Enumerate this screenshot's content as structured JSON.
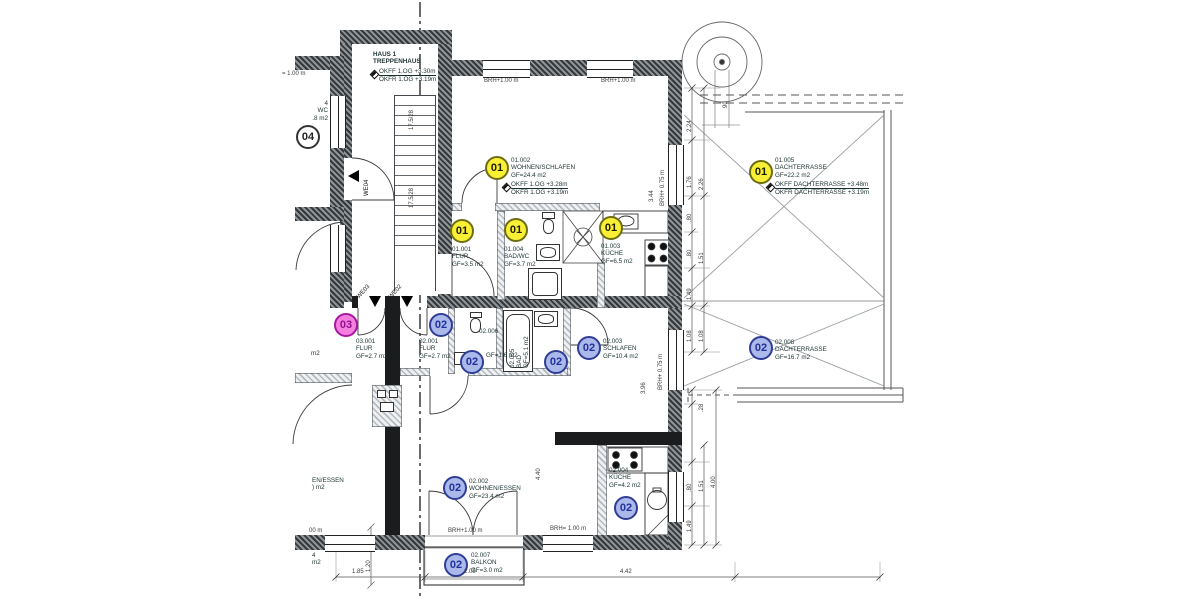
{
  "badges": {
    "u01": {
      "text": "01",
      "fill": "#f9ef35",
      "stroke": "#6d6d12",
      "color": "#1c1c00"
    },
    "u02": {
      "text": "02",
      "fill": "#aab9ea",
      "stroke": "#2f3d96",
      "color": "#22309a"
    },
    "u03": {
      "text": "03",
      "fill": "#f57fdf",
      "stroke": "#a718a0",
      "color": "#93108c"
    },
    "u04": {
      "text": "04",
      "fill": "#ffffff",
      "stroke": "#333333",
      "color": "#222222"
    }
  },
  "stairwell": {
    "line1": "HAUS 1",
    "line2": "TREPPENHAUS",
    "okff": "OKFF 1.OG +3.30m",
    "okfr": "OKFR 1.OG +3.19m",
    "note": "17.5/28"
  },
  "rooms": [
    {
      "badge": "u01",
      "id": "01.002",
      "name": "WOHNEN/SCHLAFEN",
      "area": "GF=24.4 m2",
      "okff": "OKFF 1.OG +3.28m",
      "okfr": "OKFR 1.OG +3.19m"
    },
    {
      "badge": "u01",
      "id": "01.001",
      "name": "FLUR",
      "area": "GF=3.5 m2"
    },
    {
      "badge": "u01",
      "id": "01.004",
      "name": "BAD/WC",
      "area": "GF=3.7 m2"
    },
    {
      "badge": "u01",
      "id": "01.003",
      "name": "KÜCHE",
      "area": "GF=6.5 m2"
    },
    {
      "badge": "u01",
      "id": "01.005",
      "name": "DACHTERRASSE",
      "area": "GF=22.2 m2",
      "okff": "OKFF DACHTERRASSE +3.48m",
      "okfr": "OKFR DACHTERRASSE +3.19m"
    },
    {
      "badge": "u02",
      "id": "02.008",
      "name": "DACHTERRASSE",
      "area": "GF=16.7 m2"
    },
    {
      "badge": "u03",
      "id": "03.001",
      "name": "FLUR",
      "area": "GF=2.7 m2"
    },
    {
      "badge": "u02",
      "id": "02.001",
      "name": "FLUR",
      "area": "GF=2.7 m2"
    },
    {
      "badge": "u02",
      "id": "02.006",
      "name": "WC",
      "area": "GF=1.6 m2"
    },
    {
      "badge": "u02",
      "id": "02.005",
      "name": "BAD",
      "area": "GF=5.1 m2"
    },
    {
      "badge": "u02",
      "id": "02.003",
      "name": "SCHLAFEN",
      "area": "GF=10.4 m2"
    },
    {
      "badge": "u02",
      "id": "02.002",
      "name": "WOHNEN/ESSEN",
      "area": "GF=23.4 m2"
    },
    {
      "badge": "u02",
      "id": "02.004",
      "name": "KÜCHE",
      "area": "GF=4.2 m2"
    },
    {
      "badge": "u02",
      "id": "02.007",
      "name": "BALKON",
      "area": "GF=3.0 m2"
    }
  ],
  "partials": {
    "p04_num": "4",
    "p04_wc": "WC",
    "p04_area": ".8 m2",
    "essen": "EN/ESSEN",
    "essen_m2": ") m2",
    "mid_m2": "m2",
    "low_4": "4",
    "low_m2": "m2"
  },
  "windows": {
    "top_left_partial": "= 1.00 m",
    "top1": "BRH+1.00 m",
    "top2": "BRH+1.00 m",
    "right1": "BRH+ 0.75 m",
    "right2": "BRH+ 0.75 m",
    "bottom1": "BRH+1.00 m",
    "bottom2": "BRH= 1.00 m",
    "bottom_left_partial": "00 m"
  },
  "entrances": {
    "we02": "WE02",
    "we03": "WE03",
    "we04": "WE04"
  },
  "dimensions": {
    "bottom": [
      "1.85",
      "2.05",
      "4.42"
    ],
    "balcony_depth": "1.20",
    "right_upper": [
      "2.24",
      "1.76",
      ".80",
      ".80",
      "1.49",
      "1.08"
    ],
    "right_upper2": [
      "2.26",
      "1.51",
      "1.08"
    ],
    "right_lower": [
      ".28",
      ".80",
      "1.49"
    ],
    "right_lower2": [
      "1.51",
      "4.00"
    ],
    "room_heights": [
      "3.44",
      "3.96",
      "4.40"
    ],
    "circle_note": "90"
  }
}
